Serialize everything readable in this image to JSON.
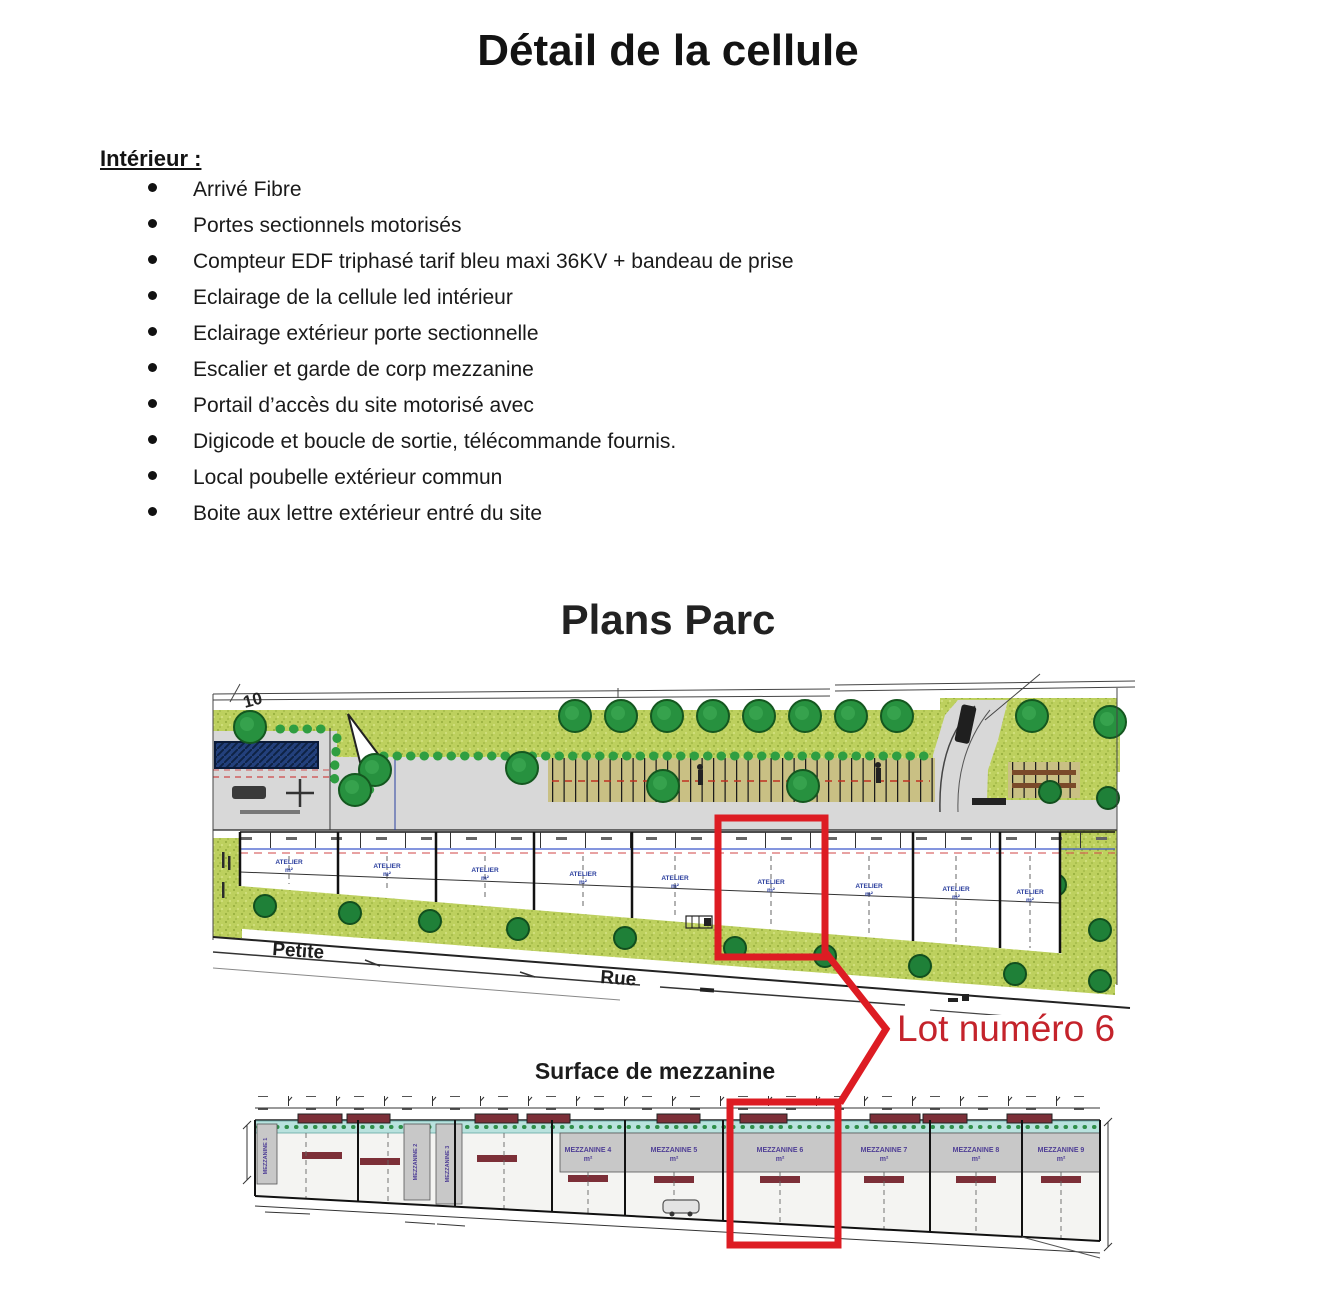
{
  "page": {
    "title": "Détail de la cellule"
  },
  "interior": {
    "heading": "Intérieur :",
    "items": [
      "Arrivé Fibre",
      "Portes sectionnels motorisés",
      "Compteur EDF triphasé tarif bleu maxi 36KV + bandeau de prise",
      "Eclairage de la cellule led intérieur",
      "Eclairage extérieur porte sectionnelle",
      "Escalier et garde de corp mezzanine",
      "Portail d’accès du site motorisé avec",
      "Digicode et boucle de sortie, télécommande fournis.",
      "Local poubelle extérieur commun",
      "Boite aux lettre extérieur entré du site"
    ]
  },
  "plans": {
    "heading": "Plans Parc",
    "parcel_number": "10",
    "street_word_1": "Petite",
    "street_word_2": "Rue",
    "unit_label": "ATELIER",
    "unit_area": "m²",
    "lot_callout": "Lot numéro 6"
  },
  "mezzanine": {
    "heading": "Surface de mezzanine",
    "unit_labels": [
      "MEZZANINE 4",
      "MEZZANINE 5",
      "MEZZANINE 6",
      "MEZZANINE 7",
      "MEZZANINE 8",
      "MEZZANINE 9"
    ],
    "vertical_labels": [
      "MEZZANINE 1",
      "MEZZANINE 2",
      "MEZZANINE 3"
    ],
    "area_label": "m²"
  },
  "colors": {
    "annotation_red": "#dd1c23",
    "callout_text_red": "#c4232b",
    "tree_green": "#27913f",
    "grass_green": "#bdd05e",
    "parking_tan": "#c9c084",
    "road_gray": "#d8d8d8",
    "building_blue": "#23407c",
    "unit_label_blue": "#2b3f9e",
    "mezzanine_teal": "#b9e2de",
    "mezzanine_gray": "#c8c8c8",
    "mezzanine_maroon": "#7c2f38",
    "mezzanine_label_purple": "#4f3f96"
  }
}
